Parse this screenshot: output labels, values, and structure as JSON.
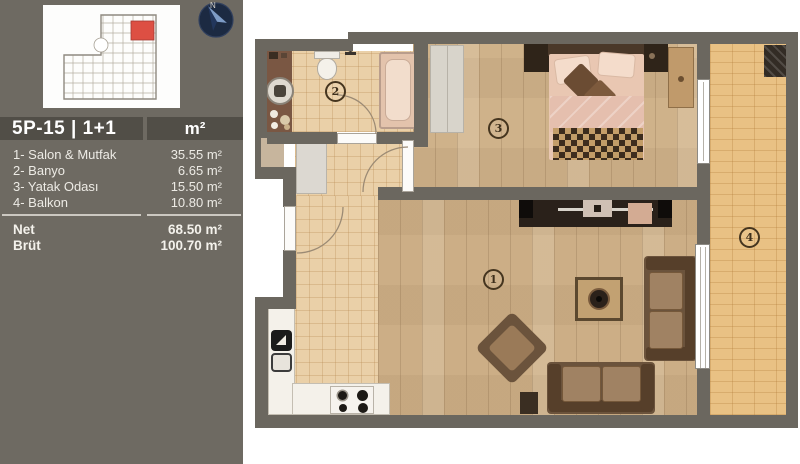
{
  "sidebar": {
    "unit_title": "5P-15 | 1+1",
    "area_unit_header": "m²",
    "rooms": [
      {
        "label": "1- Salon & Mutfak",
        "area": "35.55 m²"
      },
      {
        "label": "2- Banyo",
        "area": "6.65 m²"
      },
      {
        "label": "3- Yatak Odası",
        "area": "15.50 m²"
      },
      {
        "label": "4- Balkon",
        "area": "10.80 m²"
      }
    ],
    "totals": [
      {
        "label": "Net",
        "area": "68.50 m²"
      },
      {
        "label": "Brüt",
        "area": "100.70 m²"
      }
    ],
    "compass_label": "N",
    "highlight_color": "#dd4f43"
  },
  "plan": {
    "badges": [
      "1",
      "2",
      "3",
      "4"
    ],
    "wall_color": "#6b675f"
  }
}
